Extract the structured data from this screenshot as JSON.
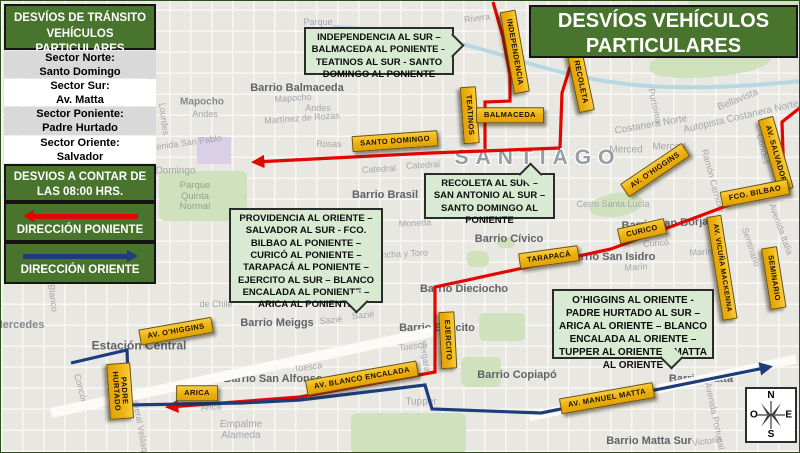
{
  "title": "DESVÍOS VEHÍCULOS PARTICULARES",
  "legend": {
    "header": "DESVÍOS DE TRÁNSITO VEHÍCULOS PARTICULARES",
    "sectors": [
      {
        "label": "Sector Norte:",
        "value": "Santo Domingo"
      },
      {
        "label": "Sector Sur:",
        "value": "Av. Matta"
      },
      {
        "label": "Sector Poniente:",
        "value": "Padre Hurtado"
      },
      {
        "label": "Sector Oriente:",
        "value": "Salvador"
      }
    ],
    "schedule": "DESVIOS A CONTAR DE LAS 08:00 HRS.",
    "direction_west": "DIRECCIÓN PONIENTE",
    "direction_east": "DIRECCIÓN ORIENTE"
  },
  "callouts": {
    "north": "INDEPENDENCIA AL SUR – BALMACEDA AL PONIENTE – TEATINOS AL SUR - SANTO DOMINGO AL PONIENTE",
    "recoleta": "RECOLETA AL SUR – SAN ANTONIO AL SUR – SANTO DOMINGO AL PONIENTE",
    "west": "PROVIDENCIA AL ORIENTE – SALVADOR AL SUR - FCO. BILBAO AL PONIENTE – CURICÓ AL PONIENTE – TARAPACÁ AL PONIENTE – EJERCITO AL SUR – BLANCO ENCALADA AL PONIENTE – ARICA AL PONIENTE",
    "east": "O’HIGGINS AL ORIENTE  - PADRE HURTADO AL SUR – ARICA AL ORIENTE – BLANCO ENCALADA AL ORIENTE – TUPPER AL ORIENTE – MATTA AL ORIENTE"
  },
  "roads": {
    "santo_domingo": "SANTO DOMINGO",
    "teatinos": "TEATINOS",
    "balmaceda": "BALMACEDA",
    "independencia": "INDEPENDENCIA",
    "recoleta": "RECOLETA",
    "av_salvador": "AV. SALVADOR",
    "av_ohiggins": "AV. O'HIGGINS",
    "fco_bilbao": "FCO. BILBAO",
    "curico": "CURICO",
    "tarapaca": "TARAPACÁ",
    "av_vicuna_mackenna": "AV. VICUÑA MACKENNA",
    "seminario": "SEMINARIO",
    "ejercito": "EJERCITO",
    "padre_hurtado": "PADRE\nHURTADO",
    "arica": "ARICA",
    "av_blanco_encalada": "AV. BLANCO ENCALADA",
    "av_manuel_matta": "AV. MANUEL MATTA"
  },
  "places": {
    "santiago": "SANTIAGO",
    "rivera": "Rivera",
    "parque": "Parque",
    "barrio_balmaceda": "Barrio Balmaceda",
    "mapocho": "Mapocho",
    "andes": "Andes",
    "martinez_de_rozas": "Martínez de Rozas",
    "avenida_san_pablo": "Avenida San Pablo",
    "rosas": "Rosas",
    "santo_domingo_st": "Santo Domingo",
    "parque_quinta_normal": "Parque\nQuinta\nNormal",
    "catedral": "Catedral",
    "barrio_brasil": "Barrio Brasil",
    "moneda": "Moneda",
    "concha_y_toro": "Concha y Toro",
    "barrio_civico": "Barrio Cívico",
    "barrio_dieciocho": "Barrio Dieciocho",
    "barrio_san_borja": "Barrio San Borja",
    "barrio_san_isidro": "Barrio San Isidro",
    "curico_st": "Curicó",
    "marin": "Marín",
    "seminario_st": "Seminario",
    "avenida_italia": "Avenida Italia",
    "merced": "Merced",
    "costanera_norte": "Costanera Norte",
    "autopista_costanera": "Autopista Costanera Norte",
    "bellavista": "Bellavista",
    "purisima": "Purísima",
    "condell": "Condell",
    "ramon_carnicer": "Ramón Carnicer",
    "cerro_santa_lucia": "Cerro Santa Lucía",
    "estacion_central": "Estación Central",
    "mercedes": "Mercedes",
    "barrio_meiggs": "Barrio Meiggs",
    "sazie": "Sazié",
    "gorbea": "Gorbea",
    "toesca": "Toesca",
    "vergara": "Vergara",
    "barrio_ejercito": "Barrio Ejército",
    "barrio_san_alfonso": "Barrio San Alfonso",
    "barrio_copiapo": "Barrio Copiapó",
    "tupper": "Tupper",
    "barrio_matta": "Barrio Matta",
    "barrio_matta_sur": "Barrio Matta Sur",
    "victoria": "Victoria",
    "avenida_portugal": "Avenida Portugal",
    "empalme_alameda": "Empalme\nAlameda",
    "arica_st": "Arica",
    "general_velasquez": "General Velásquez",
    "concon": "Concón",
    "blanco": "Blanco",
    "villasana": "Villasana",
    "lourdes": "Lourdes",
    "de_chile": "de Chile"
  },
  "compass": {
    "north": "N",
    "south": "S",
    "east": "E",
    "west": "O"
  },
  "colors": {
    "panel_green": "#48742d",
    "callout_green": "#d9ead3",
    "road_label_yellow": "#efb311",
    "route_west_red": "#e10600",
    "route_east_blue": "#1d3c7c"
  }
}
